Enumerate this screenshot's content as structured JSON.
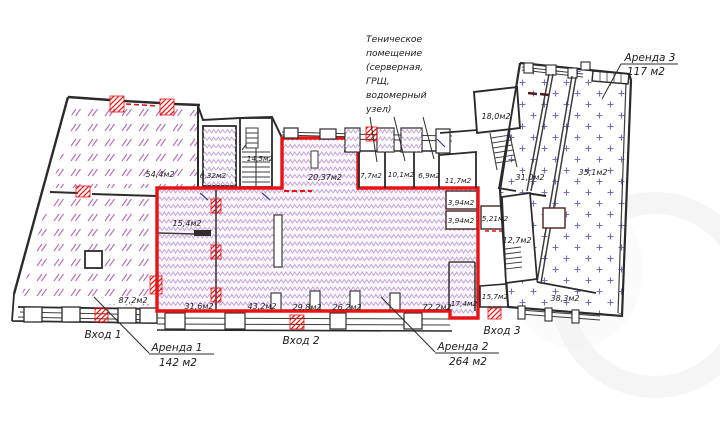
{
  "plan": {
    "rooms": {
      "r54_4": "54,4м2",
      "r6_32": "6,32м2",
      "r14_5": "14,5м2",
      "r87_2": "87,2м2",
      "r15_4": "15,4м2",
      "r20_37": "20,37м2",
      "r7_7": "7,7м2",
      "r10_1": "10,1м2",
      "r6_9": "6,9м2",
      "r11_7": "11,7м2",
      "r3_94a": "3,94м2",
      "r3_94b": "3,94м2",
      "r5_21": "5,21м2",
      "r18_0": "18,0м2",
      "r31_0": "31,0м2",
      "r35_1": "35,1м2",
      "r12_7": "12,7м2",
      "r31_6": "31,6м2",
      "r43_2": "43,2м2",
      "r29_8": "29,8м2",
      "r26_2": "26,2м2",
      "r72_2": "72,2м2",
      "r17_4": "17,4м2",
      "r15_7": "15,7м2",
      "r38_3": "38,3м2"
    },
    "entrances": {
      "e1": "Вход 1",
      "e2": "Вход 2",
      "e3": "Вход 3"
    },
    "leases": {
      "a1": {
        "name": "Аренда 1",
        "area": "142 м2"
      },
      "a2": {
        "name": "Аренда 2",
        "area": "264 м2"
      },
      "a3": {
        "name": "Аренда 3",
        "area": "117 м2"
      }
    },
    "tech_note": {
      "l1": "Теническое",
      "l2": "помещение",
      "l3": "(серверная,",
      "l4": "ГРЩ,",
      "l5": "водомерный",
      "l6": "узел)"
    }
  },
  "colors": {
    "lease_outline": "#e81313",
    "hatch_magenta": "#a855a8",
    "hatch_lavender": "#c4a3d6",
    "hatch_blue": "#7070bf",
    "wall": "#2b2b2b"
  }
}
